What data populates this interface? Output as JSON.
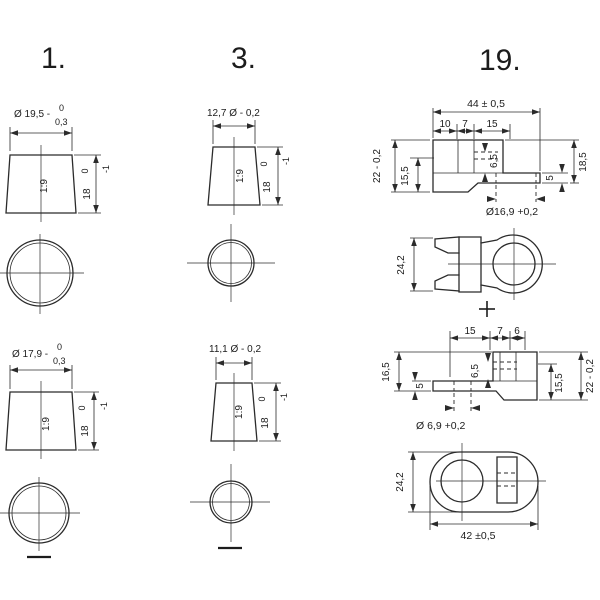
{
  "colors": {
    "background": "#ffffff",
    "line": "#2b2b2b",
    "text": "#1c1c1c"
  },
  "headings": {
    "type1": "1.",
    "type3": "3.",
    "type19": "19."
  },
  "type1": {
    "top_post": {
      "diameter": "Ø 19,5 -",
      "dia_tol_upper": "0",
      "dia_tol_lower": "0,3",
      "taper": "1:9",
      "height": "18",
      "height_tol_upper": "0",
      "height_tol_lower": "-1"
    },
    "bottom_post": {
      "diameter": "Ø 17,9 -",
      "dia_tol_upper": "0",
      "dia_tol_lower": "0,3",
      "taper": "1:9",
      "height": "18",
      "height_tol_upper": "0",
      "height_tol_lower": "-1"
    },
    "bottom_polarity_symbol": "-"
  },
  "type3": {
    "top_post": {
      "diameter": "12,7 Ø - 0,2",
      "taper": "1:9",
      "height": "18",
      "height_tol_upper": "0",
      "height_tol_lower": "-1"
    },
    "bottom_post": {
      "diameter": "11,1 Ø - 0,2",
      "taper": "1:9",
      "height": "18",
      "height_tol_upper": "0",
      "height_tol_lower": "-1"
    },
    "bottom_polarity_symbol": "-"
  },
  "type19": {
    "side_view_positive": {
      "overall_width": "44 ± 0,5",
      "seg_a": "10",
      "seg_b": "7",
      "seg_c": "15",
      "height_left": "22 - 0,2",
      "seat_height": "15,5",
      "hole_depth": "6,5",
      "tab_thickness": "5",
      "height_right": "18,5",
      "hole_dia": "Ø16,9  +0,2"
    },
    "top_view_positive": {
      "height": "24,2",
      "polarity_symbol": "+"
    },
    "side_view_negative": {
      "seg_a": "15",
      "seg_b": "7",
      "seg_c": "6",
      "height_left": "16,5",
      "tab_thickness": "5",
      "hole_depth": "6,5",
      "seat_height": "15,5",
      "height_right": "22 - 0,2",
      "hole_dia": "Ø 6,9  +0,2"
    },
    "top_view_negative": {
      "height": "24,2",
      "overall_width": "42 ±0,5"
    }
  }
}
